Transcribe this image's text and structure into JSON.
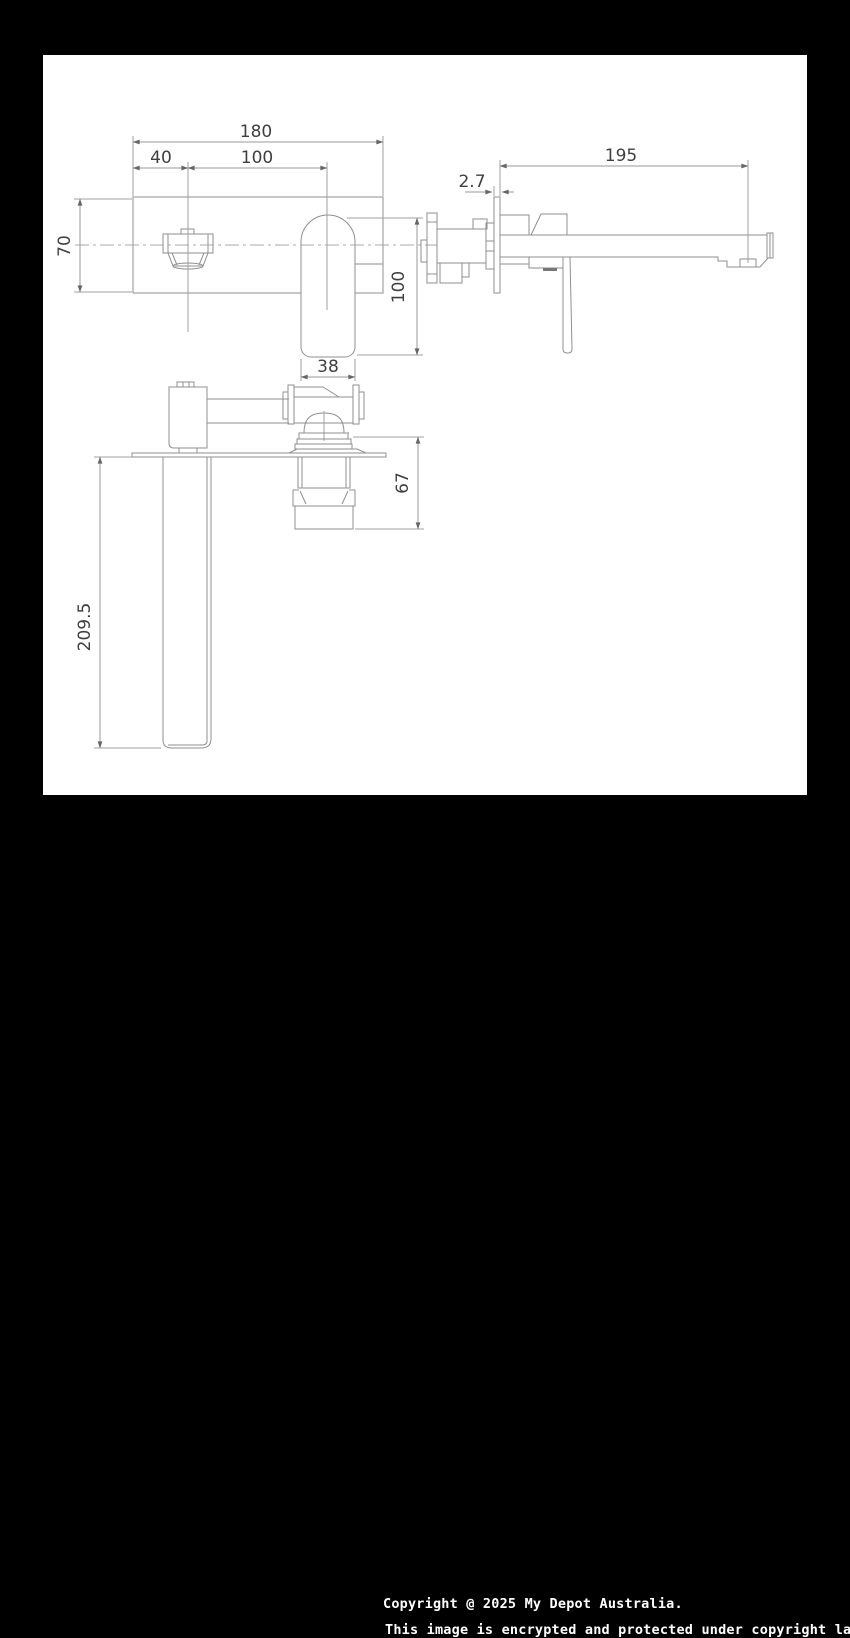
{
  "drawing": {
    "title": "wall-mounted basin mixer dimension drawing",
    "front_view": {
      "overall_width": "180",
      "spout_offset": "40",
      "spout_to_handle": "100",
      "plate_height": "70",
      "handle_height": "100",
      "handle_width": "38"
    },
    "side_view": {
      "spout_reach": "195",
      "plate_thickness": "2.7"
    },
    "top_view": {
      "spout_length": "209.5",
      "body_depth": "67"
    }
  },
  "footer": {
    "line1": "Copyright @ 2025 My Depot Australia.",
    "line2": "This image is encrypted and protected under copyright law."
  },
  "colors": {
    "background": "#000000",
    "paper": "#ffffff",
    "line": "#8f8f8f",
    "dimension_line": "#989898",
    "dimension_text": "#3f3f3f",
    "footer_text": "#ffffff"
  }
}
